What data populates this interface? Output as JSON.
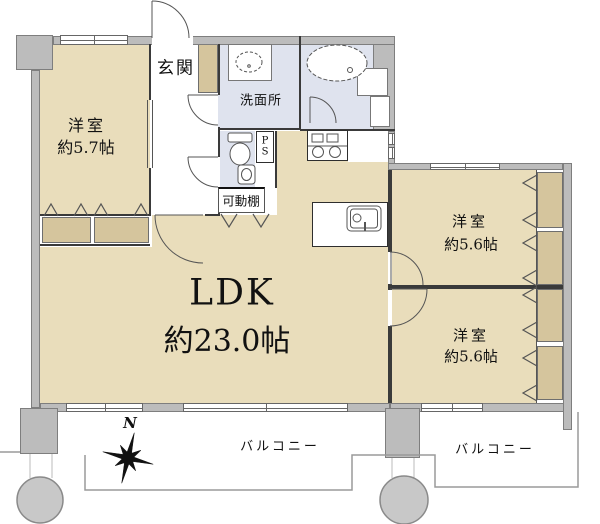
{
  "plan": {
    "labels": {
      "entrance": "玄関",
      "washroom": "洗面所",
      "movable_shelf": "可動棚",
      "pipe_space_p": "P",
      "pipe_space_s": "S",
      "north": "N"
    },
    "rooms": {
      "bedroom_west": {
        "name": "洋室",
        "size": "約5.7帖"
      },
      "ldk": {
        "name": "LDK",
        "size": "約23.0帖"
      },
      "bedroom_east_upper": {
        "name": "洋室",
        "size": "約5.6帖"
      },
      "bedroom_east_lower": {
        "name": "洋室",
        "size": "約5.6帖"
      },
      "balcony_left": "バルコニー",
      "balcony_right": "バルコニー"
    },
    "colors": {
      "floor": "#e9ddbb",
      "closet": "#d5c59d",
      "wet_area": "#dfe3ee",
      "outer_wall": "#bcbcbc",
      "inner_wall": "#3a3a3a",
      "pillar": "#c8c8c8",
      "balcony_line": "#9a9a9a",
      "text": "#111111"
    },
    "icons": {
      "compass": "compass-rose-icon",
      "bathtub": "bathtub-icon",
      "wash_basin": "wash-basin-icon",
      "toilet": "toilet-icon",
      "stove": "stove-icon",
      "kitchen_sink": "kitchen-sink-icon"
    }
  }
}
